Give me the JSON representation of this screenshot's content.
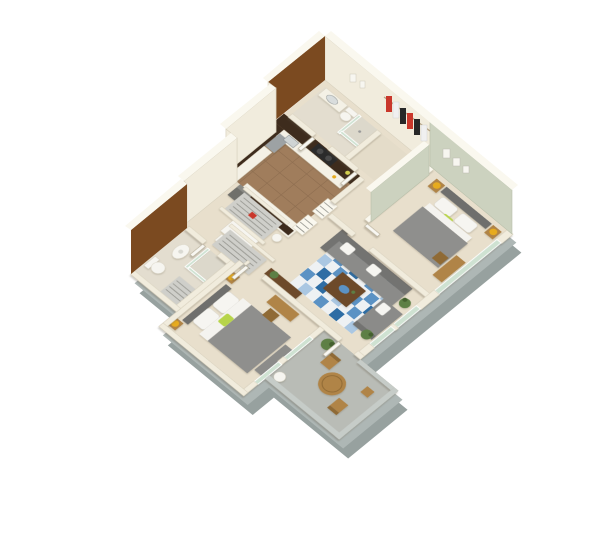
{
  "view": {
    "type": "isometric-3d-floorplan-render",
    "background": "#ffffff",
    "units": "two-bedroom two-bath apartment with patio"
  },
  "palette": {
    "bg": "#ffffff",
    "slab": "#aeb7b5",
    "slabDark": "#97a19f",
    "capGray": "#c6ccc8",
    "wallFace": "#f1ecdd",
    "wallCap": "#faf8ef",
    "wallEdge": "#d9d2bf",
    "brown": "#7b4a20",
    "sage": "#ccd2bf",
    "floorMain": "#e8dfcc",
    "floorBath": "#e3ddcf",
    "floorCloset": "#e4dcc9",
    "tile": "#a07d5c",
    "tileLine": "#8f6f51",
    "patio": "#b9bcb6",
    "espresso": "#3e2c1d",
    "counter": "#f4f1e6",
    "steel": "#9da2a4",
    "steelDark": "#7e8486",
    "bedGray": "#8f8f8d",
    "headboard": "#6f6f6d",
    "linen": "#f4f3ef",
    "sofa": "#8b8b89",
    "sofaBack": "#737371",
    "pillow": "#f6f5f1",
    "rugDark": "#2e6da4",
    "rugMid": "#5b92c4",
    "rugPale": "#aac7e2",
    "rugWhite": "#eef1f3",
    "wood": "#b08447",
    "woodDark": "#8f6a35",
    "tableDark": "#6d4a2a",
    "gold": "#e7ab1e",
    "lime": "#b7d44a",
    "plant": "#5d7f45",
    "plantDark": "#44602f",
    "glass": "#cfe2d2",
    "clothRed": "#c9372b",
    "clothBlack": "#272727",
    "clothWhite": "#f0f0f0",
    "shelf": "#cfcfca",
    "shelfLine": "#9a9a94",
    "hvac": "#70706b"
  },
  "scene": {
    "rooms": [
      {
        "name": "kitchen",
        "floor": "brown-tile",
        "features": [
          "espresso L-shaped upper cabinets",
          "stainless refrigerator",
          "black cooktop with burners",
          "white counters",
          "breakfast bar with 4 stools",
          "white dining table with 2 chairs",
          "pantry shelving"
        ]
      },
      {
        "name": "top-bathroom",
        "features": [
          "vanity with sink",
          "toilet",
          "glass shower"
        ]
      },
      {
        "name": "walk-in-closet",
        "features": [
          "hanging clothes red white black on rail"
        ]
      },
      {
        "name": "master-bedroom",
        "walls": "sage-green",
        "features": [
          "gray bed white pillows lime accent pillow",
          "two nightstands with gold lamps",
          "desk and chair",
          "wall art frames",
          "SE windows"
        ]
      },
      {
        "name": "living-room",
        "features": [
          "gray L-sectional sofa with white pillows",
          "blue checkered rug",
          "dark wood coffee table with blue bowl",
          "console table with plant",
          "two window plants",
          "SE windows"
        ]
      },
      {
        "name": "hallway",
        "features": [
          "two wire-shelf closets",
          "utility HVAC unit"
        ]
      },
      {
        "name": "left-bathroom",
        "walls": "brown-accent",
        "features": [
          "oval pedestal sink",
          "toilet",
          "glass shower",
          "linen rack"
        ]
      },
      {
        "name": "left-bedroom",
        "features": [
          "gray bed white pillows lime pillow",
          "two nightstands with gold lamps",
          "desk and chair",
          "foot bench",
          "sliding glass windows to patio"
        ]
      },
      {
        "name": "patio",
        "floor": "concrete-gray",
        "features": [
          "round wood table",
          "two wood chairs",
          "side stool",
          "potted plant",
          "laundry basket"
        ]
      }
    ],
    "accents": [
      "brown accent wall near kitchen (NW)",
      "brown accent wall at left bathroom (NW)",
      "gray foundation slab along lower edges"
    ]
  }
}
